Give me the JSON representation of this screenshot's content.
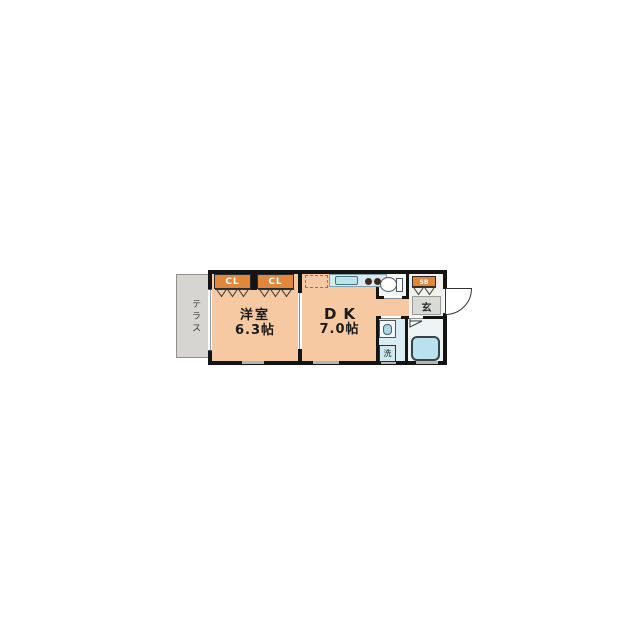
{
  "plan": {
    "terrace_label": "テラス",
    "western_room": {
      "name": "洋室",
      "area": "6.3帖"
    },
    "dining_kitchen": {
      "name": "DK",
      "area": "7.0帖"
    },
    "closets": [
      {
        "label": "CL"
      },
      {
        "label": "CL"
      }
    ],
    "shoe_box_label": "SB",
    "entrance_label": "玄",
    "laundry_label": "洗",
    "colors": {
      "room_fill": "#f6c9a2",
      "closet_fill": "#e0873c",
      "terrace_fill": "#d6d5d1",
      "sanitary_floor": "#d9edf2",
      "bath_floor": "#eef4f3",
      "fixture_blue": "#b9e2ee",
      "wall": "#141414"
    }
  }
}
